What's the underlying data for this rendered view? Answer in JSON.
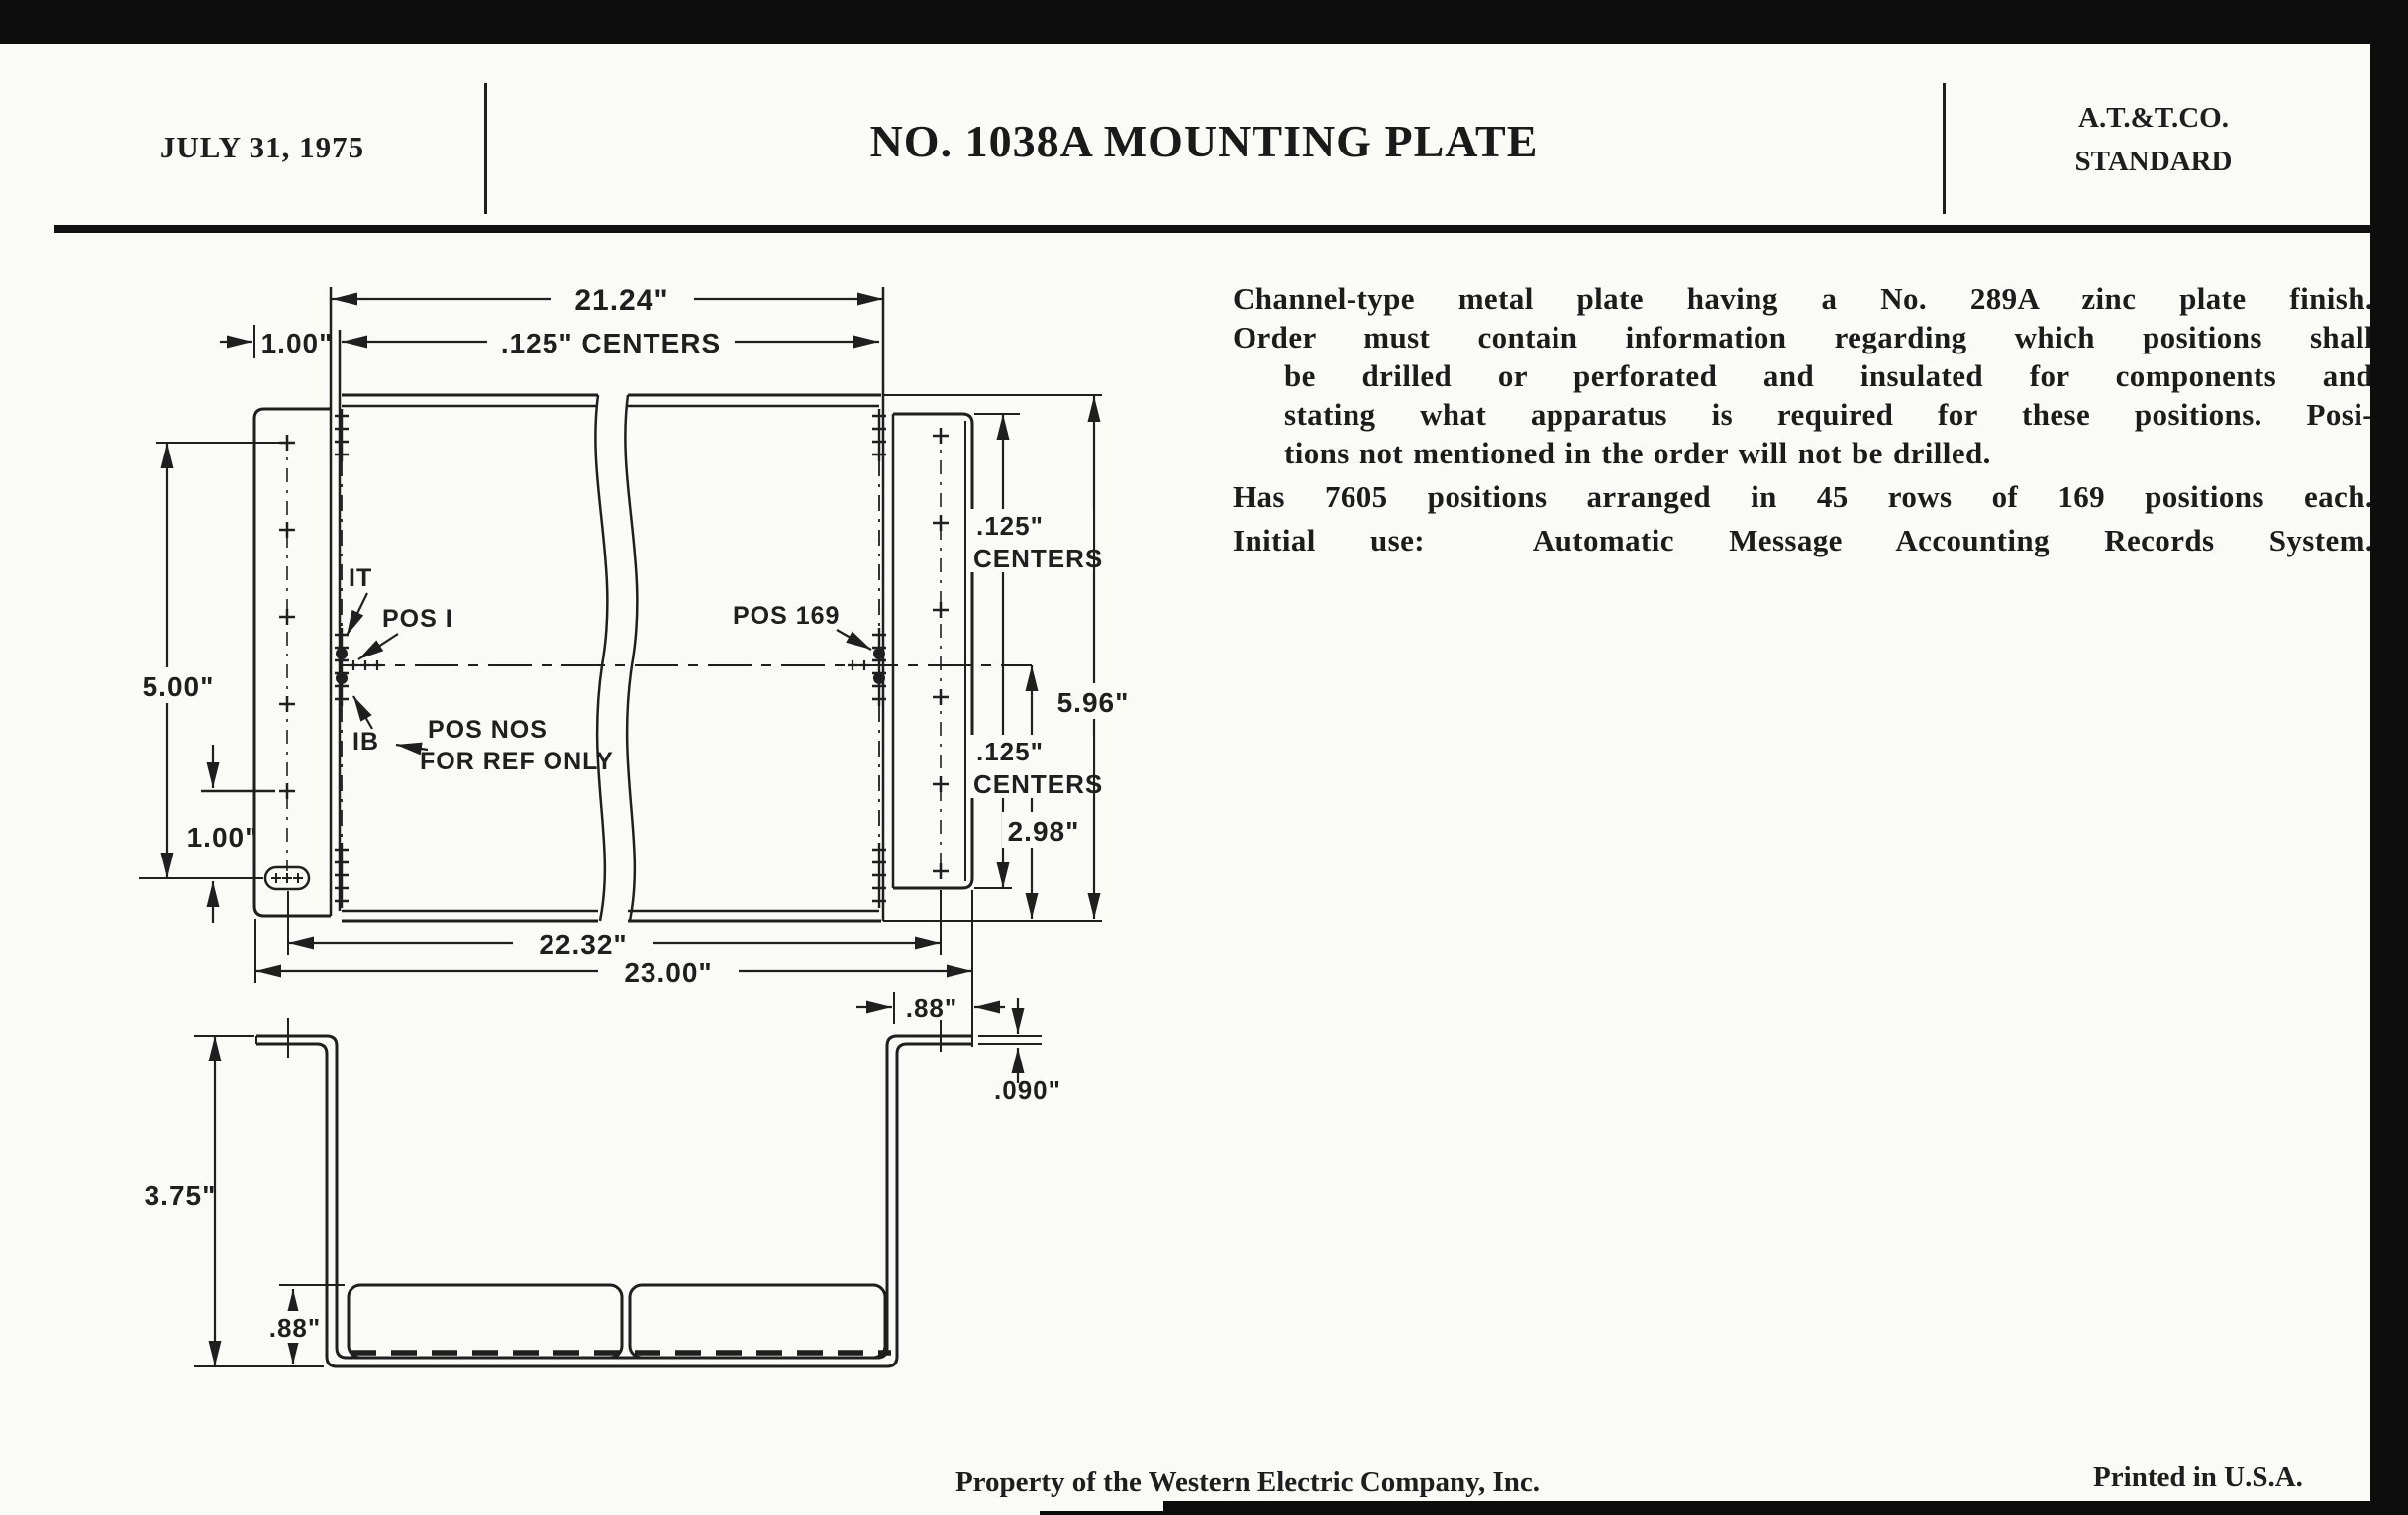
{
  "colors": {
    "ink": "#1f1f1f",
    "paper": "#fafaf7",
    "bar": "#0d0d0d"
  },
  "header": {
    "date": "JULY 31, 1975",
    "title": "NO. 1038A MOUNTING PLATE",
    "org_line1": "A.T.&T.CO.",
    "org_line2": "STANDARD"
  },
  "description": {
    "p1": "Channel-type metal plate having a No. 289A zinc plate finish.",
    "p2_l1": "Order must contain information regarding which positions shall",
    "p2_l2": "be drilled or perforated and insulated for components and",
    "p2_l3": "stating what apparatus is required for these positions. Posi-",
    "p2_l4": "tions not mentioned in the order will not be drilled.",
    "p3": "Has 7605 positions arranged in 45 rows of 169 positions each.",
    "p4": "Initial use:  Automatic Message Accounting Records System."
  },
  "front_view": {
    "dim_21_24": "21.24\"",
    "dim_125_centers_top": ".125\" CENTERS",
    "dim_1_00_top": "1.00\"",
    "dim_5_00": "5.00\"",
    "dim_1_00_bottom": "1.00\"",
    "label_1t": "IT",
    "label_pos1": "POS I",
    "label_1b": "IB",
    "label_pos_nos": "POS NOS",
    "label_for_ref": "FOR REF ONLY",
    "label_pos169": "POS 169",
    "dim_right_upper_125": ".125\"",
    "dim_right_upper_centers": "CENTERS",
    "dim_5_96": "5.96\"",
    "dim_right_lower_125": ".125\"",
    "dim_right_lower_centers": "CENTERS",
    "dim_2_98": "2.98\"",
    "dim_22_32": "22.32\"",
    "dim_23_00": "23.00\""
  },
  "profile_view": {
    "dim_88_right": ".88\"",
    "dim_090": ".090\"",
    "dim_3_75": "3.75\"",
    "dim_88_left": ".88\""
  },
  "footer": {
    "property": "Property of the Western Electric Company, Inc.",
    "printed": "Printed in U.S.A."
  }
}
